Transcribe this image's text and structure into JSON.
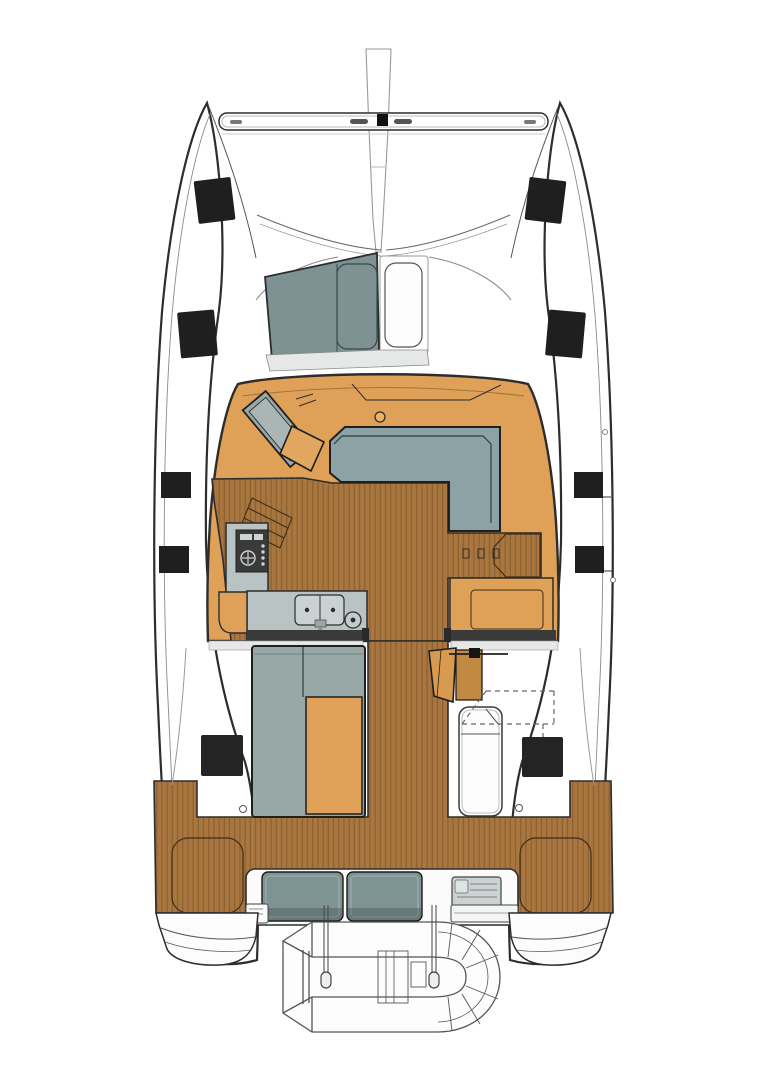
{
  "meta": {
    "type": "boat-floor-plan",
    "description": "Top-down deck layout plan of a sailing catamaran: bow trampoline with crossbeam and bowsprit, coachroof saloon with L-sofa, navigation station and galley, cockpit with table, helm seat and sun lounger, aft teak deck with stern bench, twin transoms and an inflatable dinghy hung on davits astern",
    "visible_text": "none"
  },
  "palette": {
    "background": "#ffffff",
    "outline": "#2d2d2d",
    "line_light": "#8a8a8a",
    "cabin_orange": "#dfa058",
    "cabin_orange_mid": "#d89a4f",
    "cabin_orange_dark": "#c28942",
    "wood": "#a8763e",
    "wood_line": "#6f4b22",
    "wood_edge": "#3f2f18",
    "furniture_gray": "#8ca2a4",
    "table_gray": "#97a8a6",
    "windshield_gray": "#7e9294",
    "counter_gray": "#b9c3c3",
    "sink_gray": "#c9d1d1",
    "cushion_gray": "#7e9394",
    "console_gray": "#ccd2d2",
    "stove_dark": "#3a3a3a",
    "hatch_black": "#1f1f1f",
    "sill_gray": "#e6e8e7",
    "dinghy_line": "#555555"
  },
  "labels": {
    "boat": "Catamaran deck plan",
    "port_hull": "Port hull",
    "starboard_hull": "Starboard hull",
    "bowsprit": "Bowsprit",
    "crossbeam": "Forward crossbeam",
    "foredeck": "Foredeck and bridgedeck front",
    "windshield": "Coachroof front windshield panel",
    "foredeck_hatches": "Foredeck hatches",
    "side_hatches": "Side deck hatches",
    "saloon": "Saloon coachroof",
    "saloon_floor": "Saloon wooden sole",
    "nav_station": "Navigation station desk",
    "nav_seat": "Navigation seat",
    "sofa": "L-shaped saloon sofa",
    "galley": "Galley counters",
    "stove": "Galley stove",
    "sink": "Double galley sink",
    "steps_port": "Port hull companionway steps",
    "steps_starboard": "Starboard hull companionway steps",
    "cabinet": "Starboard saloon cabinet",
    "cockpit": "Cockpit",
    "cockpit_table": "Cockpit table and bench",
    "helm_seat": "Folding helm seat",
    "sunlounger": "Cockpit sun lounger",
    "cockpit_hatches": "Cockpit sole hatches",
    "aft_deck": "Aft teak deck",
    "lockers": "Aft deck locker lids",
    "stern_bench": "Stern bench with cushions",
    "grill_console": "Stern console",
    "transoms": "Twin transom steps",
    "dinghy": "Inflatable dinghy on davits",
    "davits": "Davit straps"
  }
}
